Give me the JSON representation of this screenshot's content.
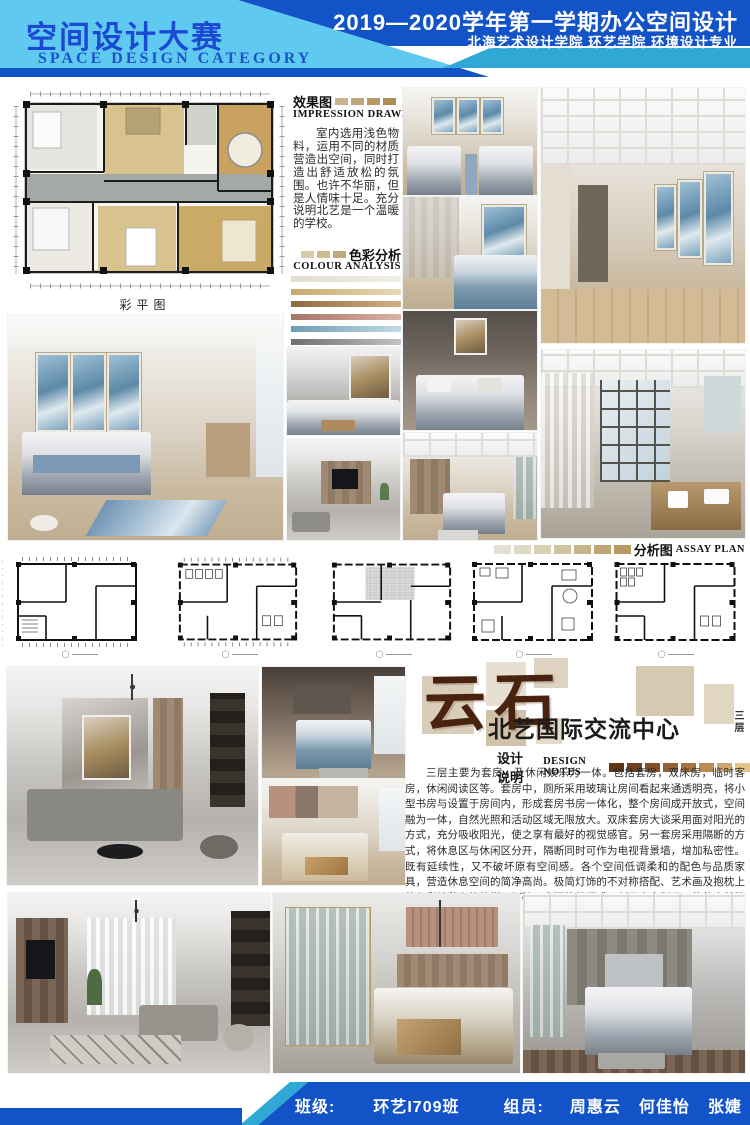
{
  "header": {
    "title_cn": "空间设计大赛",
    "title_en": "SPACE DESIGN CATEGORY",
    "course_line": "2019—2020学年第一学期办公空间设计",
    "school_line": "北海艺术设计学院 环艺学院 环境设计专业",
    "colors": {
      "light_blue": "#5fc9ef",
      "dark_blue": "#1353c8",
      "cyan_stripe": "#2fa8d5",
      "title_blue": "#1b49d4"
    }
  },
  "impression": {
    "label_cn": "效果图",
    "label_en": "IMPRESSION DRAWING",
    "swatches": [
      "#c8b489",
      "#bfa878",
      "#b69a64",
      "#ac8f55"
    ],
    "text": "室内选用浅色物料，运用不同的材质营造出空间，同时打造出舒适放松的氛围。也许不华丽，但是人情味十足。充分说明北艺是一个温暖的学校。"
  },
  "colour_analysis": {
    "label_cn": "色彩分析",
    "label_en": "COLOUR ANALYSIS",
    "swatches": [
      "#d9cba9",
      "#ccbc90",
      "#bfa87a"
    ],
    "bars": [
      [
        "#e2dcce",
        "#f2efe7"
      ],
      [
        "#caa96f",
        "#e8dab4"
      ],
      [
        "#8a6c41",
        "#cfb382"
      ],
      [
        "#a5756a",
        "#dcb2a6"
      ],
      [
        "#6d9cb2",
        "#c2dae4"
      ],
      [
        "#6e6e6e",
        "#c2c2c2"
      ]
    ]
  },
  "plan_color_caption": "彩平图",
  "assay": {
    "label_cn": "分析图",
    "label_en": "ASSAY PLAN",
    "swatches": [
      "#e6e0d4",
      "#e0d8c6",
      "#d9ceb6",
      "#d1c2a2",
      "#c8b48c",
      "#bfa574",
      "#b69a62"
    ]
  },
  "brand": {
    "logo": "云石",
    "name": "北艺国际交流中心",
    "floor": "三层"
  },
  "design_notes": {
    "label_cn": "设计说明",
    "label_en": "DESIGN NOTES",
    "swatches": [
      "#5f3517",
      "#70421f",
      "#815029",
      "#936034",
      "#a67242",
      "#ba8a55",
      "#cfa76e",
      "#e2c48d"
    ],
    "text": "三层主要为套房，及休闲娱乐为一体。包括套房，双床房，临时客房，休闲阅读区等。套房中，厕所采用玻璃让房间看起来通透明亮，将小型书房与设置于房间内，形成套房书房一体化，整个房间成开放式，空间融为一体，自然光照和活动区域无限放大。双床套房大谈采用面对阳光的方式，充分吸收阳光，使之享有最好的视觉感官。另一套房采用隔断的方式，将休息区与休闲区分开，隔断同时可作为电视背景墙，增加私密性。既有延续性，又不破坏原有空间感。各个空间低调柔和的配色与品质家具，营造休息空间的简净高尚。极简灯饰的不对称搭配、艺术画及抱枕上的色彩地毯上的纹样，打破了空间的单调感，彰显室内别具一格的审美格调。"
  },
  "footer": {
    "class_label": "班级:",
    "class_value": "环艺I709班",
    "members_label": "组员:",
    "members": [
      "周惠云",
      "何佳怡",
      "张婕"
    ]
  }
}
